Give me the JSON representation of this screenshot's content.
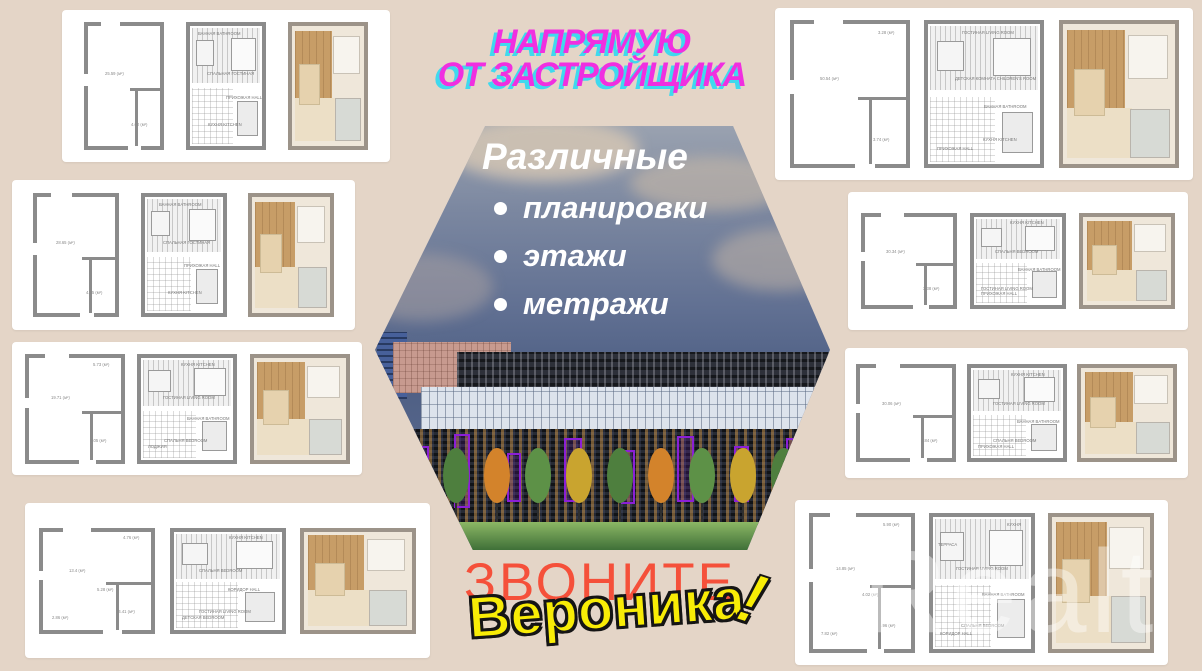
{
  "header": {
    "line1": "НАПРЯМУЮ",
    "line2": "ОТ ЗАСТРОЙЩИКА"
  },
  "hexagon": {
    "title": "Различные",
    "bullets": [
      "планировки",
      "этажи",
      "метражи"
    ]
  },
  "footer": {
    "call": "ЗВОНИТЕ",
    "name": "Вероника",
    "exclaim": "!"
  },
  "watermark": "Realt",
  "palette": {
    "background": "#e4d5c7",
    "tagline_magenta": "#f02fe0",
    "tagline_cyan_shadow": "#3fd9ee",
    "hexagon_text_white": "#ffffff",
    "call_red": "#f5503a",
    "name_yellow": "#f8ec06",
    "sky_blue": "#4e5f84",
    "building_purple_accent": "#8b1fd6",
    "card_white": "#ffffff",
    "plan_wall_gray": "#8b8b8b"
  },
  "cards": [
    {
      "position": "left-row-1",
      "plans": [
        {
          "variant": "outline",
          "labels": [
            "25.59 (м²)",
            "4.60 (м²)"
          ]
        },
        {
          "variant": "technical",
          "labels": [
            "СПАЛЬНАЯ ГОСТИНАЯ",
            "КУХНЯ KITCHEN",
            "ВАННАЯ BATHROOM",
            "ПРИХОЖАЯ HALL"
          ]
        },
        {
          "variant": "render",
          "labels": []
        }
      ]
    },
    {
      "position": "left-row-2",
      "plans": [
        {
          "variant": "outline",
          "labels": [
            "28.65 (м²)",
            "4.95 (м²)"
          ]
        },
        {
          "variant": "technical",
          "labels": [
            "СПАЛЬНАЯ ГОСТИНАЯ",
            "КУХНЯ KITCHEN",
            "ВАННАЯ BATHROOM",
            "ПРИХОЖАЯ HALL"
          ]
        },
        {
          "variant": "render",
          "labels": []
        }
      ]
    },
    {
      "position": "left-row-3",
      "plans": [
        {
          "variant": "outline",
          "labels": [
            "19.71 (м²)",
            "4.05 (м²)",
            "5.73 (м²)"
          ]
        },
        {
          "variant": "technical",
          "labels": [
            "ГОСТИНАЯ LIVING ROOM",
            "СПАЛЬНЯ BEDROOM",
            "КУХНЯ KITCHEN",
            "ВАННАЯ BATHROOM",
            "ЛОДЖИЯ"
          ]
        },
        {
          "variant": "render",
          "labels": []
        }
      ]
    },
    {
      "position": "left-row-4",
      "plans": [
        {
          "variant": "outline",
          "labels": [
            "13.4 (м²)",
            "14.41 (м²)",
            "4.76 (м²)",
            "5.28 (м²)",
            "2.86 (м²)"
          ]
        },
        {
          "variant": "technical",
          "labels": [
            "СПАЛЬНЯ BEDROOM",
            "ГОСТИНАЯ LIVING ROOM",
            "КУХНЯ KITCHEN",
            "КОРИДОР HALL",
            "ДЕТСКАЯ BEDROOM"
          ]
        },
        {
          "variant": "render",
          "labels": []
        }
      ]
    },
    {
      "position": "right-row-1",
      "plans": [
        {
          "variant": "outline",
          "labels": [
            "50.54 (м²)",
            "3.74 (м²)",
            "3.28 (м²)"
          ]
        },
        {
          "variant": "technical",
          "labels": [
            "ДЕТСКАЯ КОМНАТА CHILDREN'S ROOM",
            "КУХНЯ KITCHEN",
            "ГОСТИНАЯ LIVING ROOM",
            "ВАННАЯ BATHROOM",
            "ПРИХОЖАЯ HALL"
          ]
        },
        {
          "variant": "render",
          "labels": []
        }
      ]
    },
    {
      "position": "right-row-2",
      "plans": [
        {
          "variant": "outline",
          "labels": [
            "30.34 (м²)",
            "3.38 (м²)"
          ]
        },
        {
          "variant": "technical",
          "labels": [
            "СПАЛЬНЯ BEDROOM",
            "ГОСТИНАЯ LIVING ROOM",
            "КУХНЯ KITCHEN",
            "ВАННАЯ BATHROOM",
            "ПРИХОЖАЯ HALL"
          ]
        },
        {
          "variant": "render",
          "labels": []
        }
      ]
    },
    {
      "position": "right-row-3",
      "plans": [
        {
          "variant": "outline",
          "labels": [
            "30.06 (м²)",
            "2.84 (м²)"
          ]
        },
        {
          "variant": "technical",
          "labels": [
            "ГОСТИНАЯ LIVING ROOM",
            "СПАЛЬНЯ BEDROOM",
            "КУХНЯ KITCHEN",
            "ВАННАЯ BATHROOM",
            "ПРИХОЖАЯ HALL"
          ]
        },
        {
          "variant": "render",
          "labels": []
        }
      ]
    },
    {
      "position": "right-row-4",
      "plans": [
        {
          "variant": "outline",
          "labels": [
            "14.85 (м²)",
            "5.96 (м²)",
            "5.90 (м²)",
            "4.02 (м²)",
            "7.82 (м²)"
          ]
        },
        {
          "variant": "technical",
          "labels": [
            "ГОСТИНАЯ LIVING ROOM",
            "СПАЛЬНЯ BEDROOM",
            "КУХНЯ",
            "ВАННАЯ BATHROOM",
            "КОРИДОР HALL",
            "ТЕРРАСА"
          ]
        },
        {
          "variant": "render",
          "labels": []
        }
      ]
    }
  ]
}
